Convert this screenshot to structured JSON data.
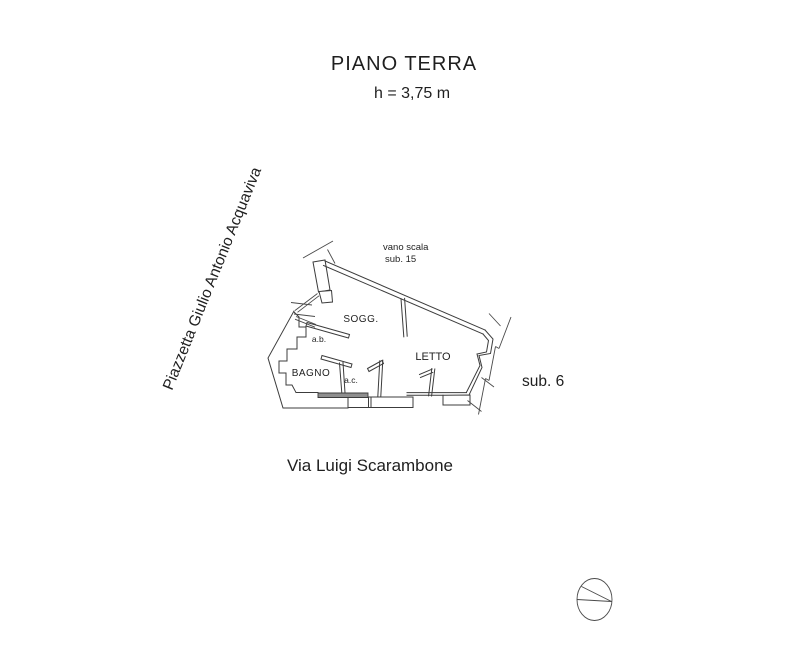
{
  "header": {
    "title": "PIANO TERRA",
    "height_note": "h = 3,75 m"
  },
  "streets": {
    "left_vertical": "Piazzetta Giulio Antonio Acquaviva",
    "bottom": "Via Luigi Scarambone"
  },
  "plan": {
    "stairwell_label_line1": "vano scala",
    "stairwell_label_line2": "sub. 15",
    "unit_label": "sub. 6",
    "rooms": [
      {
        "name": "SOGG."
      },
      {
        "name": "LETTO"
      },
      {
        "name": "BAGNO"
      },
      {
        "name": "a.b."
      },
      {
        "name": "a.c."
      }
    ]
  },
  "symbols": {
    "north_indicator": "north-circle-symbol"
  },
  "colors": {
    "line": "#3c3c3c",
    "text": "#1f1f1f",
    "wall_fill_dark": "#8e8e8e",
    "background": "#ffffff"
  }
}
